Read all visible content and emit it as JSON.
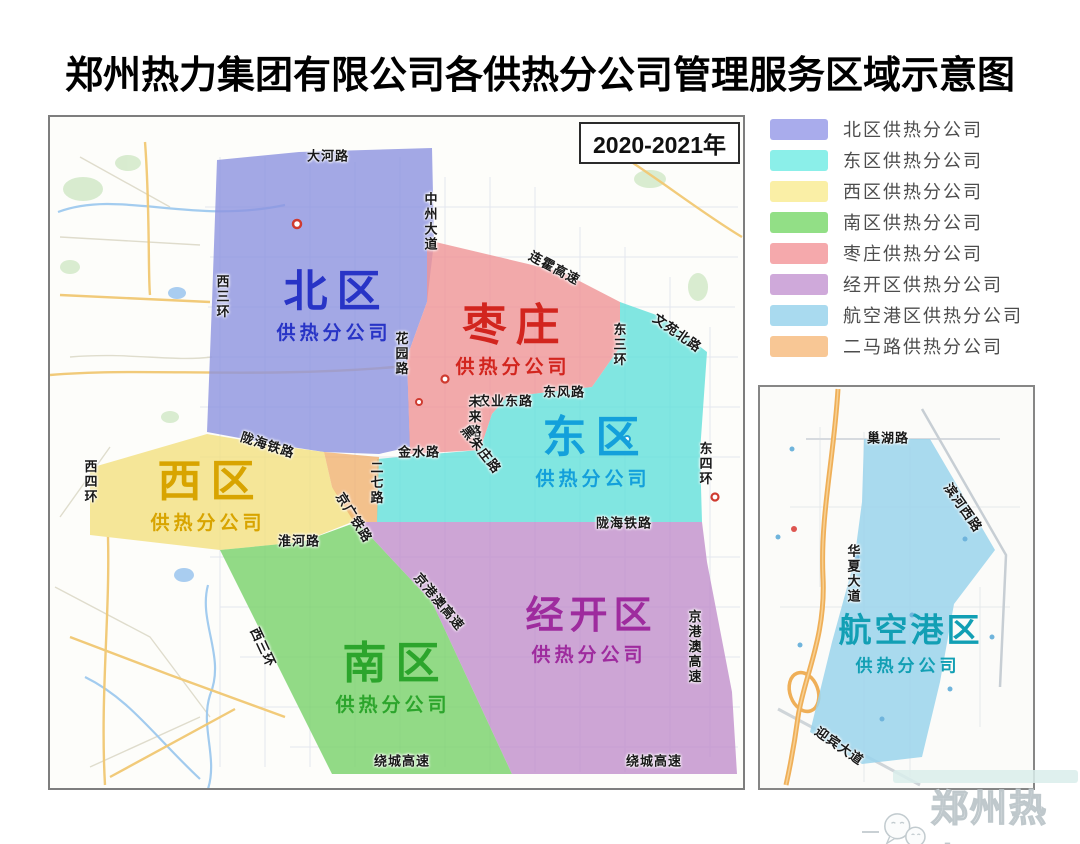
{
  "title": "郑州热力集团有限公司各供热分公司管理服务区域示意图",
  "main_map": {
    "year_label": "2020-2021年",
    "regions": [
      {
        "key": "north",
        "name": "北区",
        "subtitle": "供热分公司",
        "fill": "#8C92E0",
        "label_color": "#2834C6",
        "label_x": 282,
        "label_y": 190
      },
      {
        "key": "zaozhuang",
        "name": "枣庄",
        "subtitle": "供热分公司",
        "fill": "#EF9396",
        "label_color": "#D2251E",
        "label_x": 461,
        "label_y": 224
      },
      {
        "key": "east",
        "name": "东区",
        "subtitle": "供热分公司",
        "fill": "#62E0DB",
        "label_color": "#13A0DB",
        "label_x": 541,
        "label_y": 336
      },
      {
        "key": "west",
        "name": "西区",
        "subtitle": "供热分公司",
        "fill": "#F3E080",
        "label_color": "#D8A400",
        "label_x": 156,
        "label_y": 380
      },
      {
        "key": "south",
        "name": "南区",
        "subtitle": "供热分公司",
        "fill": "#77D169",
        "label_color": "#2CA52C",
        "label_x": 341,
        "label_y": 562
      },
      {
        "key": "jingkai",
        "name": "经开区",
        "subtitle": "供热分公司",
        "fill": "#C08FCC",
        "label_color": "#9E2B9E",
        "label_x": 537,
        "label_y": 515
      },
      {
        "key": "erma",
        "name": "",
        "subtitle": "",
        "fill": "#F0B170",
        "label_color": "",
        "label_x": 0,
        "label_y": 0
      }
    ],
    "road_labels": [
      {
        "t": "大河路",
        "x": 278,
        "y": 38,
        "o": "h"
      },
      {
        "t": "西三环",
        "x": 172,
        "y": 180,
        "o": "v"
      },
      {
        "t": "中州大道",
        "x": 380,
        "y": 105,
        "o": "v"
      },
      {
        "t": "连霍高速",
        "x": 505,
        "y": 150,
        "r": 28
      },
      {
        "t": "文苑北路",
        "x": 628,
        "y": 215,
        "r": 35
      },
      {
        "t": "东三环",
        "x": 569,
        "y": 228,
        "o": "v"
      },
      {
        "t": "花园路",
        "x": 351,
        "y": 237,
        "o": "v"
      },
      {
        "t": "农业东路",
        "x": 455,
        "y": 283,
        "o": "h"
      },
      {
        "t": "东风路",
        "x": 514,
        "y": 274,
        "o": "h"
      },
      {
        "t": "未来路",
        "x": 424,
        "y": 300,
        "o": "v"
      },
      {
        "t": "黑朱庄路",
        "x": 432,
        "y": 332,
        "r": 52
      },
      {
        "t": "金水路",
        "x": 369,
        "y": 334,
        "o": "h"
      },
      {
        "t": "东四环",
        "x": 655,
        "y": 347,
        "o": "v"
      },
      {
        "t": "陇海铁路",
        "x": 218,
        "y": 327,
        "r": 18
      },
      {
        "t": "二七路",
        "x": 326,
        "y": 366,
        "o": "v"
      },
      {
        "t": "京广铁路",
        "x": 305,
        "y": 400,
        "r": 58
      },
      {
        "t": "淮河路",
        "x": 249,
        "y": 423,
        "o": "h"
      },
      {
        "t": "西四环",
        "x": 40,
        "y": 365,
        "o": "v"
      },
      {
        "t": "陇海铁路",
        "x": 574,
        "y": 405,
        "o": "h"
      },
      {
        "t": "京港澳高速",
        "x": 644,
        "y": 530,
        "o": "v"
      },
      {
        "t": "京港澳高速",
        "x": 390,
        "y": 484,
        "r": 50
      },
      {
        "t": "西三环",
        "x": 214,
        "y": 530,
        "r": 65
      },
      {
        "t": "绕城高速",
        "x": 352,
        "y": 643,
        "o": "h"
      },
      {
        "t": "绕城高速",
        "x": 604,
        "y": 643,
        "o": "h"
      }
    ]
  },
  "legend": {
    "items": [
      {
        "label": "北区供热分公司",
        "color": "#A9ACEC"
      },
      {
        "label": "东区供热分公司",
        "color": "#8BEFE9"
      },
      {
        "label": "西区供热分公司",
        "color": "#FAEFA6"
      },
      {
        "label": "南区供热分公司",
        "color": "#92DF86"
      },
      {
        "label": "枣庄供热分公司",
        "color": "#F5A9AC"
      },
      {
        "label": "经开区供热分公司",
        "color": "#CFA9DA"
      },
      {
        "label": "航空港区供热分公司",
        "color": "#A9DAEF"
      },
      {
        "label": "二马路供热分公司",
        "color": "#F8C795"
      }
    ]
  },
  "mini_map": {
    "region": {
      "key": "airport",
      "name": "航空港区",
      "subtitle": "供热分公司",
      "fill": "#9AD3EC",
      "label_color": "#129FB4",
      "label_x": 146,
      "label_y": 258
    },
    "road_labels": [
      {
        "t": "巢湖路",
        "x": 128,
        "y": 50,
        "o": "h"
      },
      {
        "t": "滨河西路",
        "x": 204,
        "y": 120,
        "r": 55
      },
      {
        "t": "华夏大道",
        "x": 93,
        "y": 187,
        "o": "v"
      },
      {
        "t": "迎宾大道",
        "x": 80,
        "y": 358,
        "r": 35
      }
    ]
  },
  "watermark": {
    "text": "郑州热力"
  }
}
